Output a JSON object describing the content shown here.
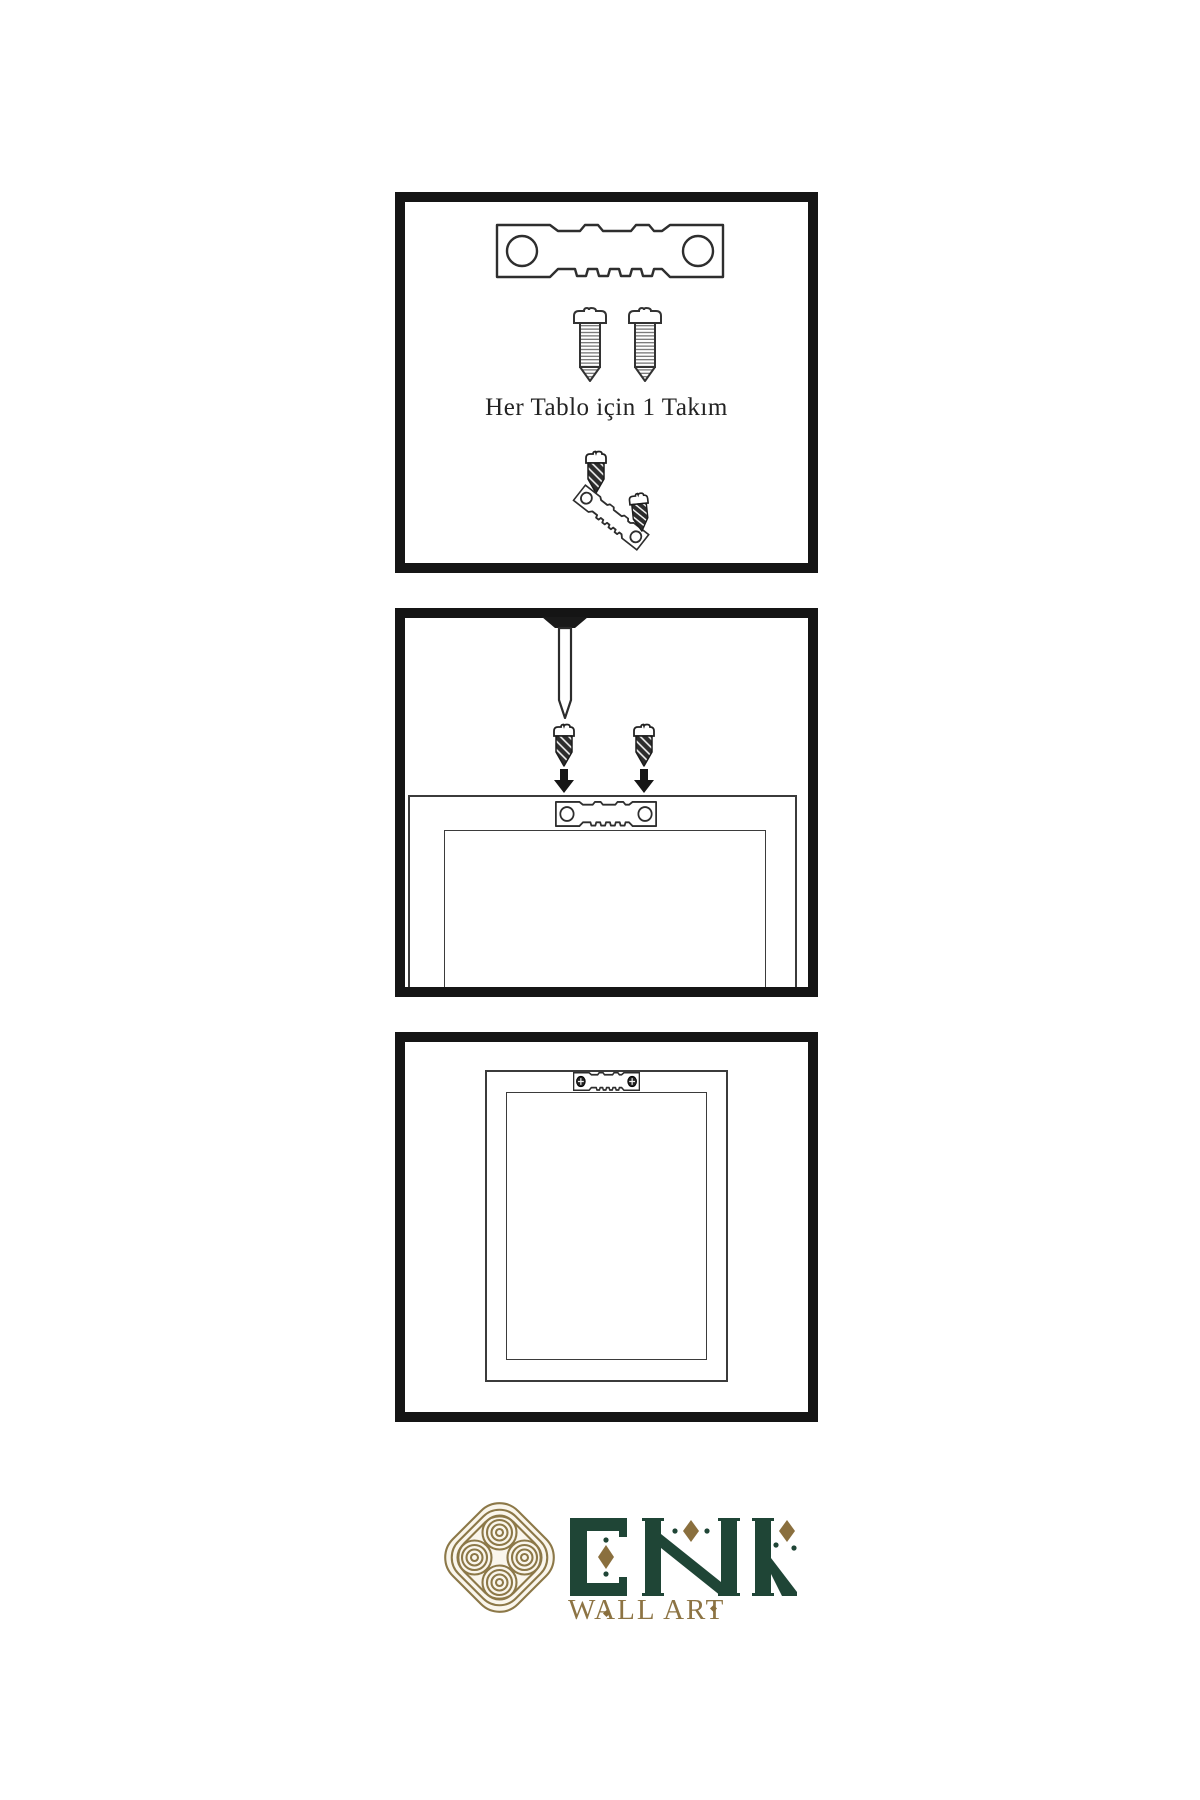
{
  "meta": {
    "brand_name": "ENK",
    "brand_tagline": "WALL ART"
  },
  "panels": [
    {
      "id": "step-1",
      "caption": "Her Tablo için 1 Takım",
      "contents": [
        "sawtooth-hanger",
        "screw",
        "screw",
        "screw-driven-into-sawtooth-hanger"
      ]
    },
    {
      "id": "step-2",
      "caption": "",
      "contents": [
        "nail-in-wall",
        "screw-with-down-arrow",
        "screw-with-down-arrow",
        "frame-back-with-sawtooth-hanger"
      ]
    },
    {
      "id": "step-3",
      "caption": "",
      "contents": [
        "frame-back-with-mounted-sawtooth-hanger"
      ]
    }
  ],
  "colors": {
    "line_art": "#2e2e2e",
    "panel_border": "#151515",
    "dark_fill": "#2d2d2d",
    "brand_green": "#1f4536",
    "brand_gold": "#8d7444",
    "knot_gold": "#8c7848",
    "knot_cream": "#faf6ec"
  }
}
